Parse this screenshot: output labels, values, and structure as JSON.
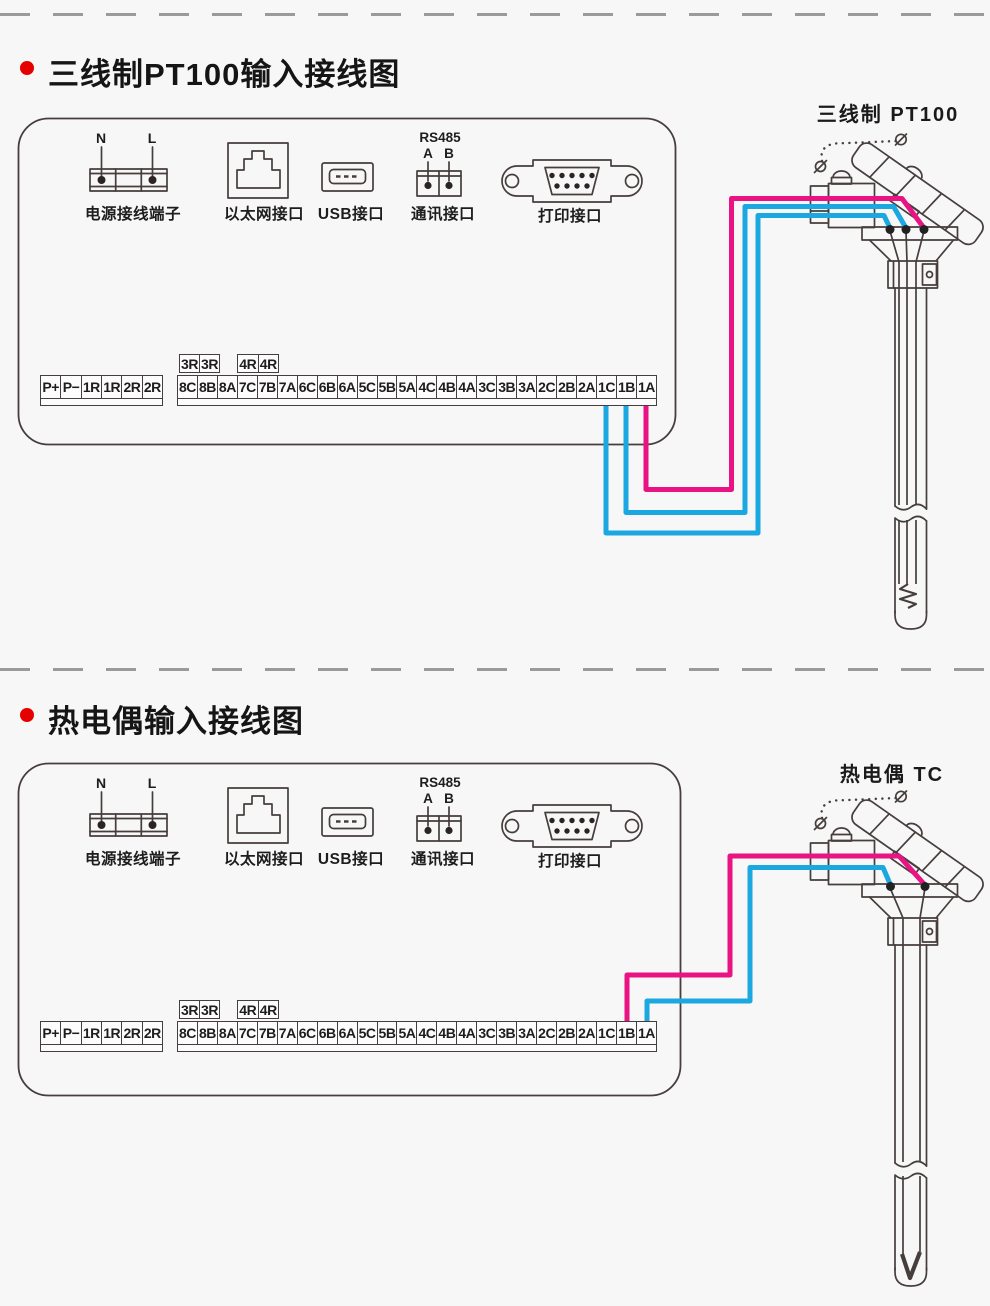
{
  "colors": {
    "wire_pink": "#e91383",
    "wire_cyan": "#1ba7e0",
    "line_art": "#463e3c",
    "bullet_red": "#e60000",
    "background": "#f7f7f7"
  },
  "sections": [
    {
      "title": "三线制PT100输入接线图",
      "sensor_label": "三线制 PT100",
      "ports": {
        "power": {
          "label": "电源接线端子",
          "pin_left": "N",
          "pin_right": "L"
        },
        "ethernet": {
          "label": "以太网接口"
        },
        "usb": {
          "label": "USB接口"
        },
        "comm": {
          "label": "通讯接口",
          "bus": "RS485",
          "pin_left": "A",
          "pin_right": "B"
        },
        "printer": {
          "label": "打印接口"
        }
      },
      "terminals": {
        "aux_boxes": [
          [
            "3R",
            "3R"
          ],
          [
            "4R",
            "4R"
          ]
        ],
        "left_row": [
          "P+",
          "P−",
          "1R",
          "1R",
          "2R",
          "2R"
        ],
        "main_row": [
          "8C",
          "8B",
          "8A",
          "7C",
          "7B",
          "7A",
          "6C",
          "6B",
          "6A",
          "5C",
          "5B",
          "5A",
          "4C",
          "4B",
          "4A",
          "3C",
          "3B",
          "3A",
          "2C",
          "2B",
          "2A",
          "1C",
          "1B",
          "1A"
        ]
      },
      "wiring": [
        {
          "terminal": "1C",
          "wire_color": "cyan"
        },
        {
          "terminal": "1B",
          "wire_color": "cyan"
        },
        {
          "terminal": "1A",
          "wire_color": "pink"
        }
      ]
    },
    {
      "title": "热电偶输入接线图",
      "sensor_label": "热电偶 TC",
      "ports": {
        "power": {
          "label": "电源接线端子",
          "pin_left": "N",
          "pin_right": "L"
        },
        "ethernet": {
          "label": "以太网接口"
        },
        "usb": {
          "label": "USB接口"
        },
        "comm": {
          "label": "通讯接口",
          "bus": "RS485",
          "pin_left": "A",
          "pin_right": "B"
        },
        "printer": {
          "label": "打印接口"
        }
      },
      "terminals": {
        "aux_boxes": [
          [
            "3R",
            "3R"
          ],
          [
            "4R",
            "4R"
          ]
        ],
        "left_row": [
          "P+",
          "P−",
          "1R",
          "1R",
          "2R",
          "2R"
        ],
        "main_row": [
          "8C",
          "8B",
          "8A",
          "7C",
          "7B",
          "7A",
          "6C",
          "6B",
          "6A",
          "5C",
          "5B",
          "5A",
          "4C",
          "4B",
          "4A",
          "3C",
          "3B",
          "3A",
          "2C",
          "2B",
          "2A",
          "1C",
          "1B",
          "1A"
        ]
      },
      "wiring": [
        {
          "terminal": "1B",
          "wire_color": "pink"
        },
        {
          "terminal": "1A",
          "wire_color": "cyan"
        }
      ]
    }
  ]
}
